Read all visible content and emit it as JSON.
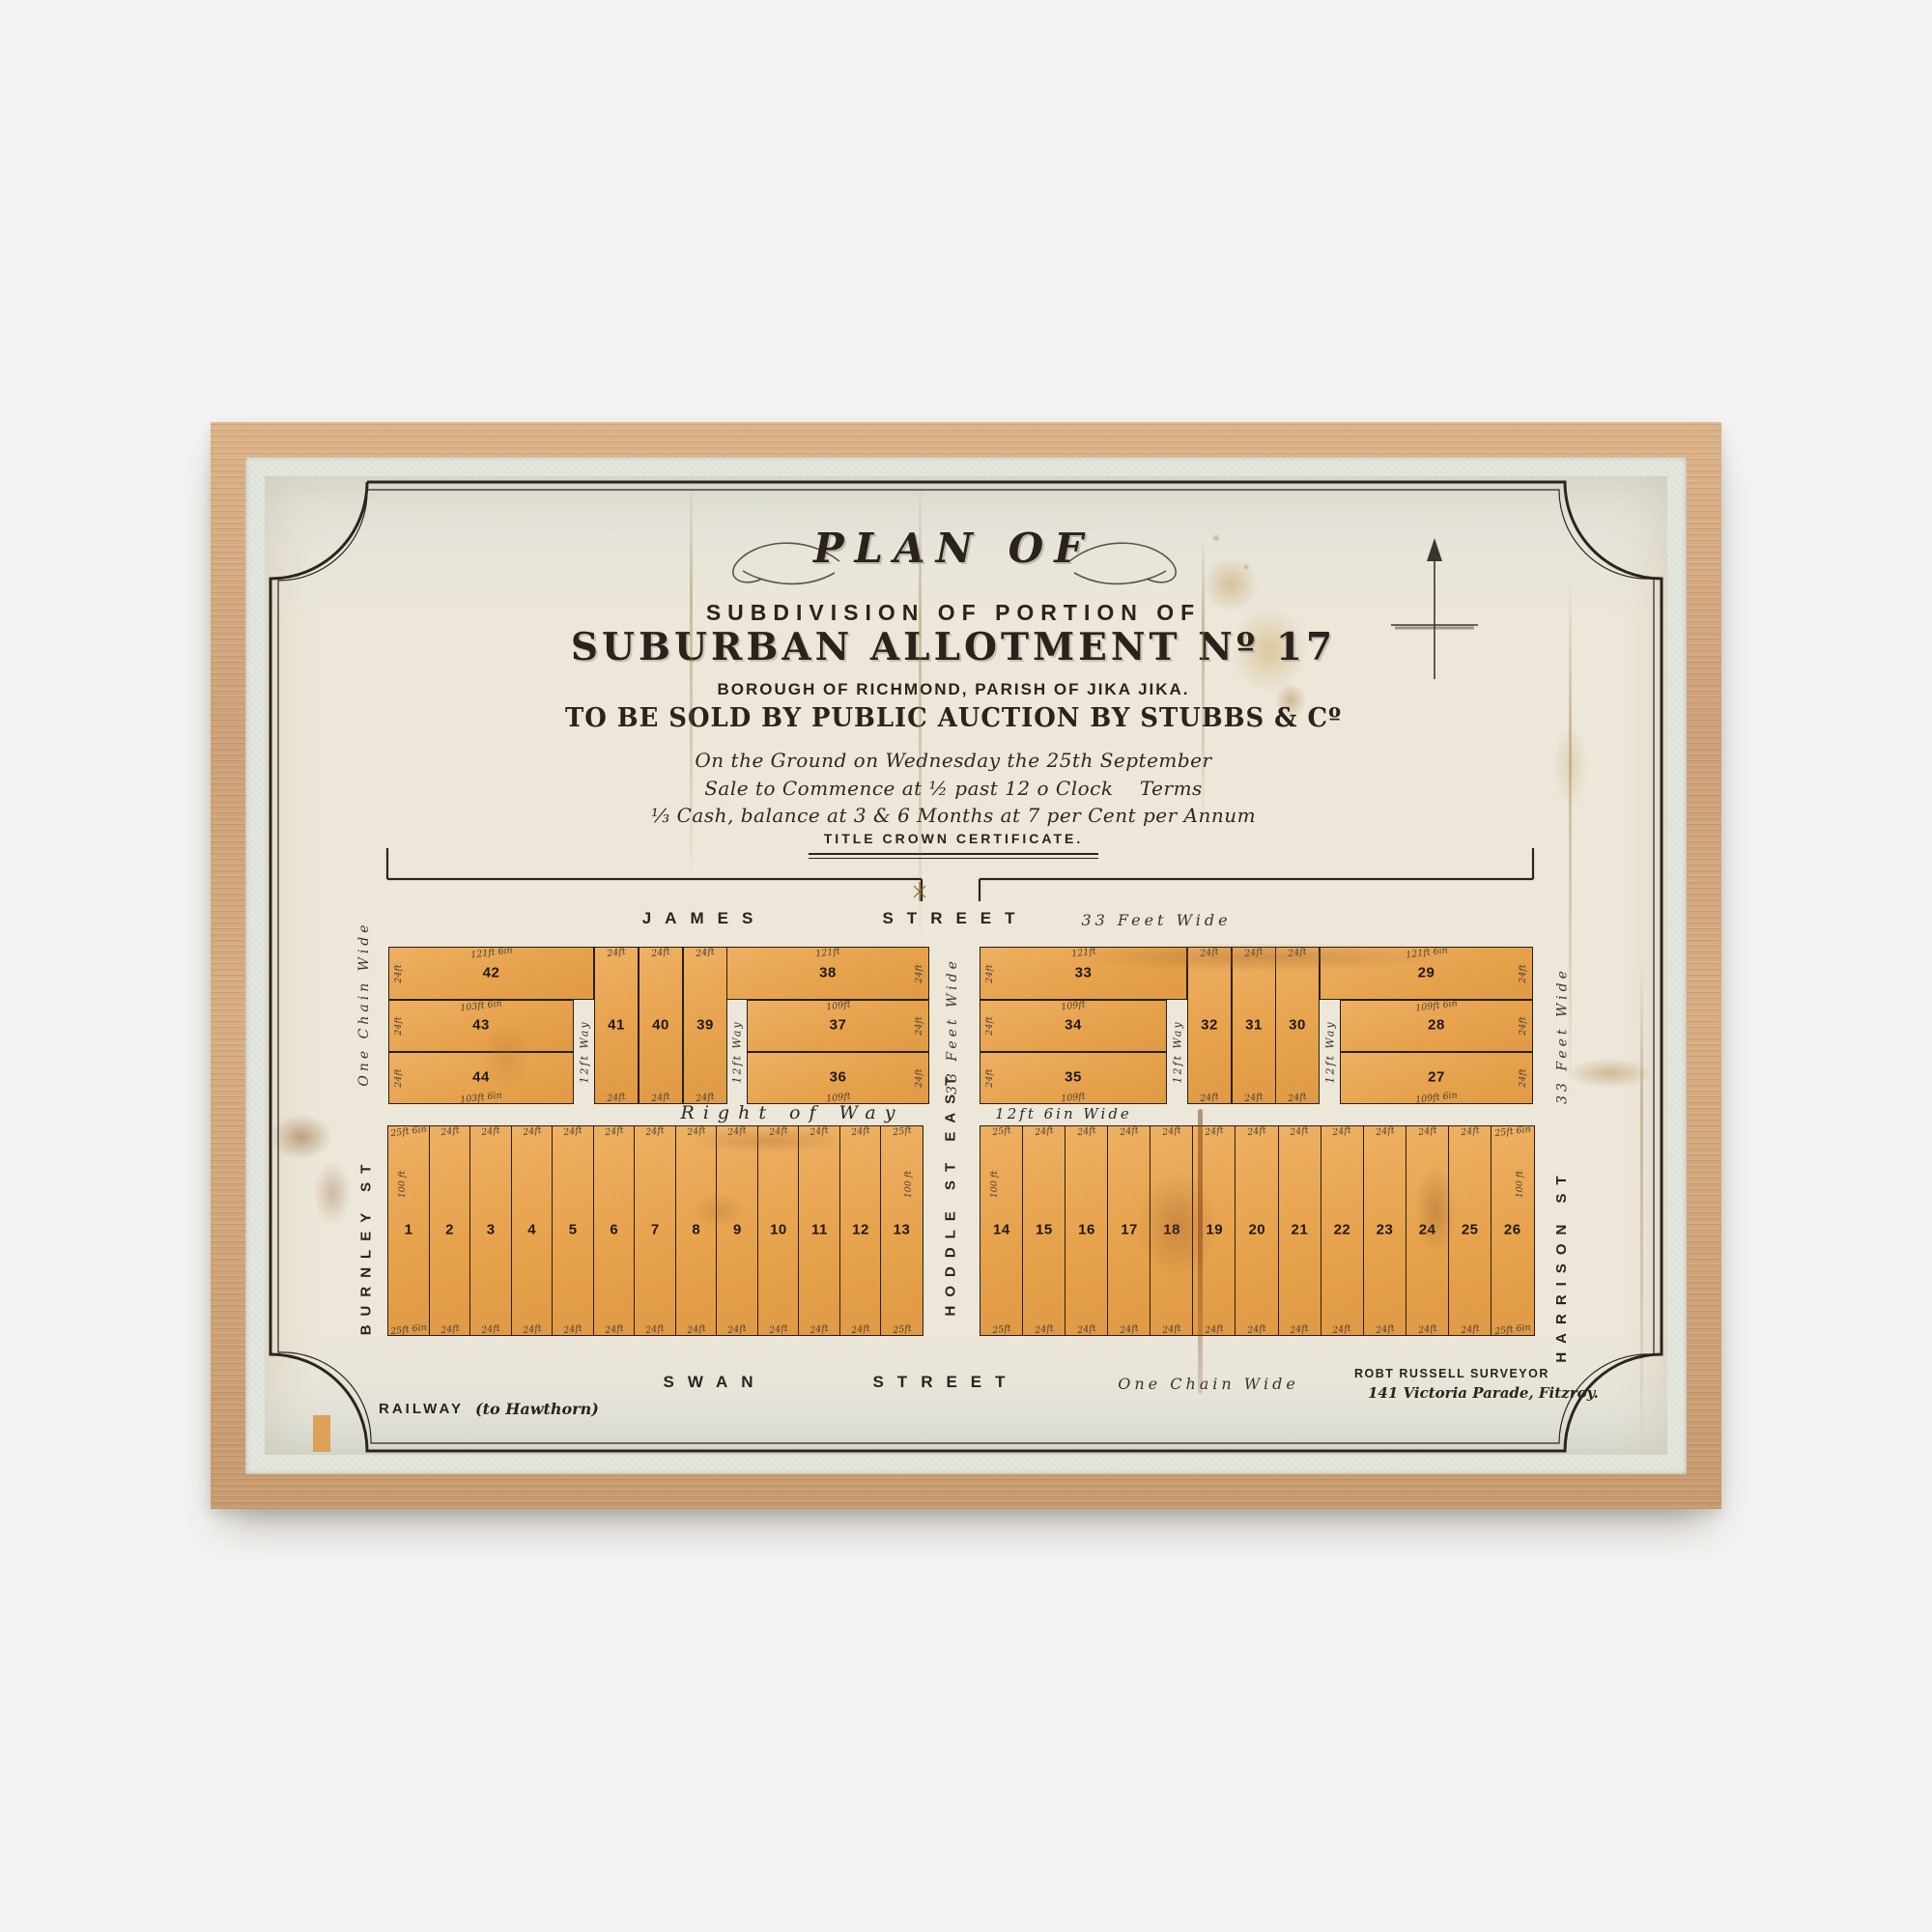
{
  "colors": {
    "paper": "#ece7d9",
    "lot_fill": "#e8a751",
    "ink": "#29231c",
    "frame_wood": "#d0a276",
    "mat": "#dfe2d8",
    "stain_rust": "#8a5a28"
  },
  "title_block": {
    "plan_of": "PLAN OF",
    "line_subdivision": "SUBDIVISION OF PORTION OF",
    "line_allotment": "SUBURBAN ALLOTMENT Nº 17",
    "line_borough": "BOROUGH OF RICHMOND, PARISH OF JIKA JIKA.",
    "line_auction": "TO BE SOLD BY PUBLIC AUCTION BY STUBBS & Cº",
    "script_1": "On the Ground on Wednesday the 25th September",
    "script_2": "Sale to Commence at ½ past 12 o Clock    Terms",
    "script_3": "⅓ Cash, balance at 3 & 6 Months at 7 per Cent per Annum",
    "title_certificate": "TITLE CROWN CERTIFICATE."
  },
  "streets": {
    "james": {
      "name": "JAMES",
      "name2": "STREET",
      "width_note": "33 Feet Wide"
    },
    "swan": {
      "name": "SWAN",
      "name2": "STREET",
      "width_note": "One Chain Wide"
    },
    "burnley": {
      "name": "BURNLEY ST",
      "width_note": "One Chain Wide"
    },
    "hoddle": {
      "name": "HODDLE ST EAST",
      "width_note": "33 Feet Wide"
    },
    "harrison": {
      "name": "HARRISON ST",
      "width_note": "33 Feet Wide"
    },
    "right_of_way": {
      "label": "Right of Way",
      "width_note": "12ft 6in Wide"
    }
  },
  "notes": {
    "railway": "RAILWAY",
    "railway_dest": "(to Hawthorn)",
    "surveyor": "ROBT RUSSELL SURVEYOR",
    "surveyor_addr": "141 Victoria Parade, Fitzroy."
  },
  "plan": {
    "upper_left": {
      "frontage": "24ft",
      "way": "12ft Way",
      "west": [
        {
          "num": "42",
          "dim": "121ft 6in"
        },
        {
          "num": "43",
          "dim": "103ft 6in"
        },
        {
          "num": "44",
          "dim": "103ft 6in"
        }
      ],
      "mid": [
        {
          "num": "41",
          "dim": "24ft"
        },
        {
          "num": "40",
          "dim": "24ft"
        },
        {
          "num": "39",
          "dim": "24ft"
        }
      ],
      "east": [
        {
          "num": "38",
          "dim": "121ft"
        },
        {
          "num": "37",
          "dim": "109ft"
        },
        {
          "num": "36",
          "dim": "109ft"
        }
      ]
    },
    "upper_right": {
      "frontage": "24ft",
      "way": "12ft Way",
      "west": [
        {
          "num": "33",
          "dim": "121ft"
        },
        {
          "num": "34",
          "dim": "109ft"
        },
        {
          "num": "35",
          "dim": "109ft"
        }
      ],
      "mid": [
        {
          "num": "32",
          "dim": "24ft"
        },
        {
          "num": "31",
          "dim": "24ft"
        },
        {
          "num": "30",
          "dim": "24ft"
        }
      ],
      "east": [
        {
          "num": "29",
          "dim": "121ft 6in"
        },
        {
          "num": "28",
          "dim": "109ft 6in"
        },
        {
          "num": "27",
          "dim": "109ft 6in"
        }
      ]
    },
    "lower_left": {
      "depth": "100 ft",
      "lots": [
        {
          "num": "1",
          "top": "25ft 6in",
          "bottom": "25ft 6in"
        },
        {
          "num": "2",
          "top": "24ft",
          "bottom": "24ft"
        },
        {
          "num": "3",
          "top": "24ft",
          "bottom": "24ft"
        },
        {
          "num": "4",
          "top": "24ft",
          "bottom": "24ft"
        },
        {
          "num": "5",
          "top": "24ft",
          "bottom": "24ft"
        },
        {
          "num": "6",
          "top": "24ft",
          "bottom": "24ft"
        },
        {
          "num": "7",
          "top": "24ft",
          "bottom": "24ft"
        },
        {
          "num": "8",
          "top": "24ft",
          "bottom": "24ft"
        },
        {
          "num": "9",
          "top": "24ft",
          "bottom": "24ft"
        },
        {
          "num": "10",
          "top": "24ft",
          "bottom": "24ft"
        },
        {
          "num": "11",
          "top": "24ft",
          "bottom": "24ft"
        },
        {
          "num": "12",
          "top": "24ft",
          "bottom": "24ft"
        },
        {
          "num": "13",
          "top": "25ft",
          "bottom": "25ft"
        }
      ]
    },
    "lower_right": {
      "depth": "100 ft",
      "lots": [
        {
          "num": "14",
          "top": "25ft",
          "bottom": "25ft"
        },
        {
          "num": "15",
          "top": "24ft",
          "bottom": "24ft"
        },
        {
          "num": "16",
          "top": "24ft",
          "bottom": "24ft"
        },
        {
          "num": "17",
          "top": "24ft",
          "bottom": "24ft"
        },
        {
          "num": "18",
          "top": "24ft",
          "bottom": "24ft"
        },
        {
          "num": "19",
          "top": "24ft",
          "bottom": "24ft"
        },
        {
          "num": "20",
          "top": "24ft",
          "bottom": "24ft"
        },
        {
          "num": "21",
          "top": "24ft",
          "bottom": "24ft"
        },
        {
          "num": "22",
          "top": "24ft",
          "bottom": "24ft"
        },
        {
          "num": "23",
          "top": "24ft",
          "bottom": "24ft"
        },
        {
          "num": "24",
          "top": "24ft",
          "bottom": "24ft"
        },
        {
          "num": "25",
          "top": "24ft",
          "bottom": "24ft"
        },
        {
          "num": "26",
          "top": "25ft 6in",
          "bottom": "25ft 6in"
        }
      ]
    }
  }
}
